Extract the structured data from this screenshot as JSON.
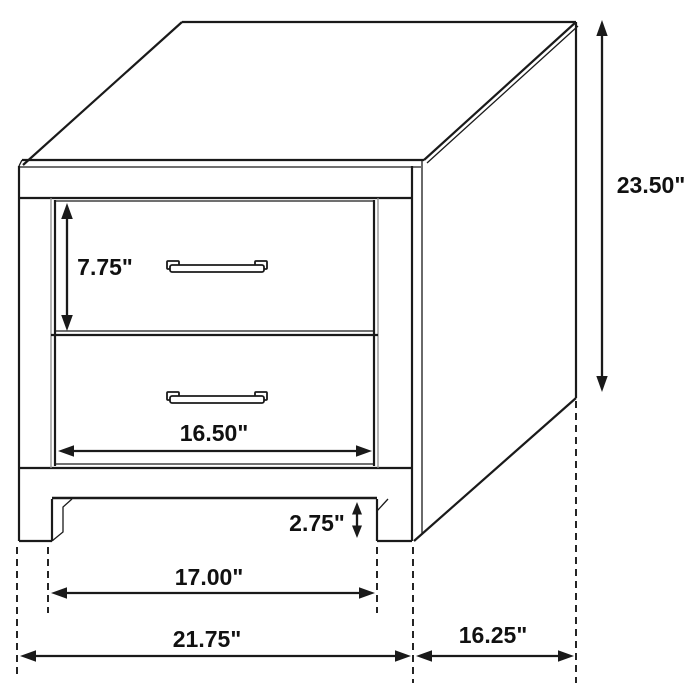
{
  "figure": {
    "kind": "furniture-dimension-diagram",
    "item": "two-drawer nightstand"
  },
  "colors": {
    "line": "#1a1a1a",
    "background": "#ffffff"
  },
  "dimensions": {
    "overall_height": {
      "label": "23.50\"",
      "value": 23.5,
      "unit": "in"
    },
    "top_drawer_height": {
      "label": "7.75\"",
      "value": 7.75,
      "unit": "in"
    },
    "drawer_width": {
      "label": "16.50\"",
      "value": 16.5,
      "unit": "in"
    },
    "base_clearance_height": {
      "label": "2.75\"",
      "value": 2.75,
      "unit": "in"
    },
    "inner_base_width": {
      "label": "17.00\"",
      "value": 17.0,
      "unit": "in"
    },
    "overall_width": {
      "label": "21.75\"",
      "value": 21.75,
      "unit": "in"
    },
    "overall_depth": {
      "label": "16.25\"",
      "value": 16.25,
      "unit": "in"
    }
  }
}
